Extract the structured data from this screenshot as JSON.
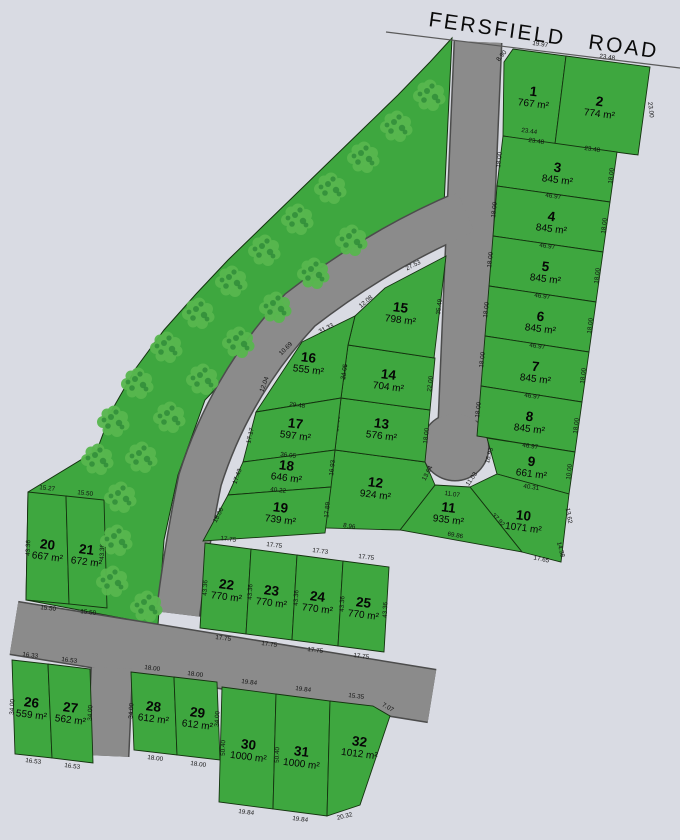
{
  "title": {
    "road_name": "FERSFIELD ROAD"
  },
  "colors": {
    "background": "#d9dbe3",
    "lot_green": "#3ea73f",
    "lot_stroke": "#14320f",
    "road_gray": "#8b8b8b",
    "road_outline": "#4c4c4c",
    "tree_light": "#57b64e",
    "tree_dark": "#2e8b38",
    "text": "#060606"
  },
  "map": {
    "frontage_line": "M386,32 L680,68",
    "strip_points": "452,38 430,62 398,95 364,128 330,161 296,194 262,227 228,260 196,294 164,330 136,368 112,410 97,450 28,492 26,600 158,625 164,540 178,475 205,400 262,340 330,292 400,235 444,205 448,120",
    "roads": {
      "stem_d": "M478,42 L470,230 L462,420",
      "stem_w": 46,
      "branch_d": "M466,212 Q380,248 300,310 Q230,385 200,480 Q186,548 178,614",
      "branch_w": 42,
      "main_d": "M14,628 L432,696",
      "main_w": 52,
      "stub_d": "M112,668 L108,756",
      "stub_w": 40,
      "bulb": {
        "cx": 455,
        "cy": 447,
        "r": 33
      }
    },
    "trees": [
      [
        430,
        95
      ],
      [
        397,
        126
      ],
      [
        364,
        157
      ],
      [
        331,
        188
      ],
      [
        298,
        219
      ],
      [
        265,
        250
      ],
      [
        232,
        281
      ],
      [
        199,
        313
      ],
      [
        167,
        347
      ],
      [
        138,
        383
      ],
      [
        114,
        421
      ],
      [
        98,
        459
      ],
      [
        352,
        240
      ],
      [
        314,
        273
      ],
      [
        276,
        307
      ],
      [
        239,
        342
      ],
      [
        203,
        379
      ],
      [
        170,
        417
      ],
      [
        142,
        457
      ],
      [
        121,
        497
      ],
      [
        117,
        540
      ],
      [
        113,
        581
      ],
      [
        147,
        606
      ]
    ],
    "lots": [
      {
        "n": "1",
        "area": "767 m²",
        "label": [
          533,
          96
        ],
        "pts": "513,49 566,56 555,144 503,136 504,62",
        "dims": [
          [
            "19.97",
            540,
            46,
            8
          ],
          [
            "8.90",
            503,
            57,
            -50
          ],
          [
            "23.44",
            529,
            133,
            8
          ]
        ]
      },
      {
        "n": "2",
        "area": "774 m²",
        "label": [
          599,
          106
        ],
        "pts": "566,56 650,67 638,155 555,144",
        "dims": [
          [
            "23.48",
            607,
            59,
            8
          ],
          [
            "23.00",
            649,
            110,
            83
          ]
        ]
      },
      {
        "n": "3",
        "area": "845 m²",
        "label": [
          557,
          172
        ],
        "pts": "503,136 617,152 610,202 497,186",
        "dims": [
          [
            "23.48",
            536,
            143,
            8
          ],
          [
            "23.48",
            592,
            151,
            8
          ],
          [
            "18.00",
            501,
            160,
            -84
          ],
          [
            "18.00",
            613,
            176,
            -84
          ]
        ]
      },
      {
        "n": "4",
        "area": "845 m²",
        "label": [
          551,
          221
        ],
        "pts": "497,186 610,202 603,252 493,236",
        "dims": [
          [
            "46.97",
            553,
            198,
            8
          ],
          [
            "18.00",
            496,
            210,
            -84
          ],
          [
            "18.00",
            606,
            226,
            -84
          ]
        ]
      },
      {
        "n": "5",
        "area": "845 m²",
        "label": [
          545,
          271
        ],
        "pts": "493,236 603,252 596,302 489,286",
        "dims": [
          [
            "46.97",
            547,
            248,
            8
          ],
          [
            "18.00",
            492,
            260,
            -84
          ],
          [
            "18.00",
            599,
            276,
            -84
          ]
        ]
      },
      {
        "n": "6",
        "area": "845 m²",
        "label": [
          540,
          321
        ],
        "pts": "489,286 596,302 589,352 485,336",
        "dims": [
          [
            "46.97",
            542,
            298,
            8
          ],
          [
            "18.00",
            488,
            310,
            -84
          ],
          [
            "18.00",
            592,
            326,
            -84
          ]
        ]
      },
      {
        "n": "7",
        "area": "845 m²",
        "label": [
          535,
          371
        ],
        "pts": "485,336 589,352 582,402 481,386",
        "dims": [
          [
            "46.97",
            537,
            348,
            8
          ],
          [
            "18.00",
            484,
            360,
            -84
          ],
          [
            "18.00",
            585,
            376,
            -84
          ]
        ]
      },
      {
        "n": "8",
        "area": "845 m²",
        "label": [
          529,
          421
        ],
        "pts": "481,386 582,402 575,452 477,436",
        "dims": [
          [
            "46.97",
            532,
            398,
            8
          ],
          [
            "18.00",
            480,
            410,
            -84
          ],
          [
            "18.00",
            578,
            426,
            -84
          ]
        ]
      },
      {
        "n": "9",
        "area": "661 m²",
        "label": [
          531,
          466
        ],
        "pts": "487,438 575,452 569,494 497,474",
        "dims": [
          [
            "46.97",
            530,
            448,
            8
          ],
          [
            "16.93",
            491,
            456,
            -74
          ],
          [
            "10.00",
            571,
            472,
            -84
          ]
        ]
      },
      {
        "n": "10",
        "area": "1071 m²",
        "label": [
          523,
          520
        ],
        "pts": "497,474 569,494 561,562 522,552 470,487",
        "dims": [
          [
            "40.31",
            531,
            489,
            8
          ],
          [
            "13.62",
            567,
            516,
            80
          ],
          [
            "14.38",
            559,
            550,
            75
          ],
          [
            "17.65",
            541,
            561,
            12
          ],
          [
            "37.92",
            497,
            521,
            46
          ],
          [
            "11.03",
            473,
            480,
            -55
          ]
        ]
      },
      {
        "n": "11",
        "area": "935 m²",
        "label": [
          448,
          512
        ],
        "pts": "435,485 470,487 522,552 400,530",
        "dims": [
          [
            "11.07",
            452,
            496,
            8
          ],
          [
            "69.86",
            455,
            537,
            10
          ],
          [
            "37.87",
            414,
            506,
            -58
          ]
        ]
      },
      {
        "n": "12",
        "area": "924 m²",
        "label": [
          375,
          487
        ],
        "pts": "335,450 425,462 435,485 400,530 325,528",
        "dims": [
          [
            "32.00",
            378,
            452,
            8
          ],
          [
            "13.64",
            429,
            474,
            -62
          ],
          [
            "8.96",
            349,
            528,
            9
          ]
        ]
      },
      {
        "n": "13",
        "area": "576 m²",
        "label": [
          381,
          428
        ],
        "pts": "341,398 430,410 425,462 335,450",
        "dims": [
          [
            "32.00",
            383,
            401,
            8
          ],
          [
            "18.00",
            428,
            436,
            -84
          ],
          [
            "18.06",
            339,
            424,
            -84
          ]
        ]
      },
      {
        "n": "14",
        "area": "704 m²",
        "label": [
          388,
          379
        ],
        "pts": "348,345 435,358 430,410 341,398",
        "dims": [
          [
            "12.00",
            386,
            350,
            8
          ],
          [
            "22.00",
            346,
            372,
            -84
          ],
          [
            "22.00",
            432,
            384,
            -84
          ]
        ]
      },
      {
        "n": "15",
        "area": "798 m²",
        "label": [
          400,
          312
        ],
        "pts": "385,288 446,256 434,358 348,345 355,316",
        "dims": [
          [
            "27.53",
            414,
            267,
            -26
          ],
          [
            "35.49",
            441,
            307,
            -83
          ],
          [
            "12.08",
            367,
            303,
            -40
          ]
        ]
      },
      {
        "n": "16",
        "area": "555 m²",
        "label": [
          308,
          362
        ],
        "pts": "302,342 355,316 348,345 341,398 256,412",
        "dims": [
          [
            "31.33",
            327,
            330,
            -26
          ],
          [
            "34.05",
            346,
            372,
            -80
          ],
          [
            "10.69",
            287,
            350,
            -45
          ],
          [
            "12.04",
            266,
            385,
            -70
          ]
        ]
      },
      {
        "n": "17",
        "area": "597 m²",
        "label": [
          295,
          428
        ],
        "pts": "256,412 341,398 335,450 243,462",
        "dims": [
          [
            "29.48",
            297,
            407,
            7
          ],
          [
            "17.17",
            252,
            436,
            -77
          ]
        ]
      },
      {
        "n": "18",
        "area": "646 m²",
        "label": [
          286,
          470
        ],
        "pts": "243,462 335,450 331,487 228,495",
        "dims": [
          [
            "36.05",
            288,
            457,
            6
          ],
          [
            "17.43",
            239,
            477,
            -70
          ],
          [
            "16.93",
            334,
            468,
            -84
          ]
        ]
      },
      {
        "n": "19",
        "area": "739 m²",
        "label": [
          280,
          512
        ],
        "pts": "228,495 331,487 325,533 203,541",
        "dims": [
          [
            "40.22",
            278,
            492,
            6
          ],
          [
            "18.06",
            220,
            516,
            -62
          ],
          [
            "17.89",
            329,
            510,
            -85
          ]
        ]
      },
      {
        "n": "20",
        "area": "667 m²",
        "label": [
          47,
          549
        ],
        "pts": "28,492 66,496 69,604 26,600",
        "dims": [
          [
            "15.27",
            47,
            490,
            6
          ],
          [
            "43.36",
            30,
            548,
            -88
          ],
          [
            "15.50",
            48,
            610,
            6
          ]
        ]
      },
      {
        "n": "21",
        "area": "672 m²",
        "label": [
          86,
          554
        ],
        "pts": "66,496 104,500 107,608 69,604",
        "dims": [
          [
            "15.50",
            85,
            495,
            6
          ],
          [
            "43.36",
            104,
            552,
            -88
          ],
          [
            "15.50",
            88,
            614,
            6
          ]
        ]
      },
      {
        "n": "22",
        "area": "770 m²",
        "label": [
          226,
          589
        ],
        "pts": "205,543 251,549 246,634 200,628",
        "dims": [
          [
            "17.75",
            228,
            541,
            7
          ],
          [
            "43.36",
            207,
            588,
            -87
          ],
          [
            "17.75",
            223,
            640,
            7
          ]
        ]
      },
      {
        "n": "23",
        "area": "770 m²",
        "label": [
          271,
          595
        ],
        "pts": "251,549 297,555 292,640 246,634",
        "dims": [
          [
            "17.75",
            274,
            547,
            7
          ],
          [
            "43.36",
            252,
            592,
            -87
          ],
          [
            "17.75",
            269,
            646,
            7
          ]
        ]
      },
      {
        "n": "24",
        "area": "770 m²",
        "label": [
          317,
          601
        ],
        "pts": "297,555 343,561 338,646 292,640",
        "dims": [
          [
            "17.73",
            320,
            553,
            7
          ],
          [
            "43.36",
            298,
            598,
            -87
          ],
          [
            "17.75",
            315,
            652,
            7
          ]
        ]
      },
      {
        "n": "25",
        "area": "770 m²",
        "label": [
          363,
          607
        ],
        "pts": "343,561 389,567 384,652 338,646",
        "dims": [
          [
            "17.75",
            366,
            559,
            7
          ],
          [
            "43.36",
            344,
            604,
            -87
          ],
          [
            "17.75",
            361,
            658,
            7
          ],
          [
            "43.36",
            387,
            610,
            -87
          ]
        ]
      },
      {
        "n": "26",
        "area": "559 m²",
        "label": [
          31,
          707
        ],
        "pts": "12,660 48,664 52,758 15,754",
        "dims": [
          [
            "16.33",
            30,
            657,
            7
          ],
          [
            "34.00",
            14,
            707,
            -87
          ],
          [
            "16.53",
            33,
            763,
            7
          ]
        ]
      },
      {
        "n": "27",
        "area": "562 m²",
        "label": [
          70,
          712
        ],
        "pts": "48,664 90,669 93,763 52,758",
        "dims": [
          [
            "16.53",
            69,
            662,
            7
          ],
          [
            "34.00",
            92,
            713,
            -87
          ],
          [
            "16.53",
            72,
            768,
            7
          ]
        ]
      },
      {
        "n": "28",
        "area": "612 m²",
        "label": [
          153,
          711
        ],
        "pts": "131,672 174,677 177,755 134,750",
        "dims": [
          [
            "18.00",
            152,
            670,
            7
          ],
          [
            "34.00",
            133,
            711,
            -86
          ],
          [
            "18.00",
            155,
            760,
            7
          ]
        ]
      },
      {
        "n": "29",
        "area": "612 m²",
        "label": [
          197,
          717
        ],
        "pts": "174,677 217,682 220,760 177,755",
        "dims": [
          [
            "18.00",
            195,
            676,
            7
          ],
          [
            "34.00",
            219,
            719,
            -86
          ],
          [
            "18.00",
            198,
            766,
            7
          ]
        ]
      },
      {
        "n": "30",
        "area": "1000 m²",
        "label": [
          248,
          749
        ],
        "pts": "222,687 276,694 273,809 219,802",
        "dims": [
          [
            "19.84",
            249,
            684,
            7
          ],
          [
            "50.40",
            225,
            748,
            -88
          ],
          [
            "19.84",
            246,
            814,
            7
          ]
        ]
      },
      {
        "n": "31",
        "area": "1000 m²",
        "label": [
          301,
          756
        ],
        "pts": "276,694 330,701 327,816 273,809",
        "dims": [
          [
            "19.84",
            303,
            691,
            7
          ],
          [
            "50.40",
            279,
            755,
            -88
          ],
          [
            "19.84",
            300,
            821,
            7
          ]
        ]
      },
      {
        "n": "32",
        "area": "1012 m²",
        "label": [
          359,
          746
        ],
        "pts": "330,701 373,706 390,716 360,805 327,816",
        "dims": [
          [
            "15.35",
            356,
            698,
            7
          ],
          [
            "7.07",
            387,
            709,
            30
          ],
          [
            "20.32",
            345,
            818,
            -14
          ]
        ]
      }
    ]
  }
}
